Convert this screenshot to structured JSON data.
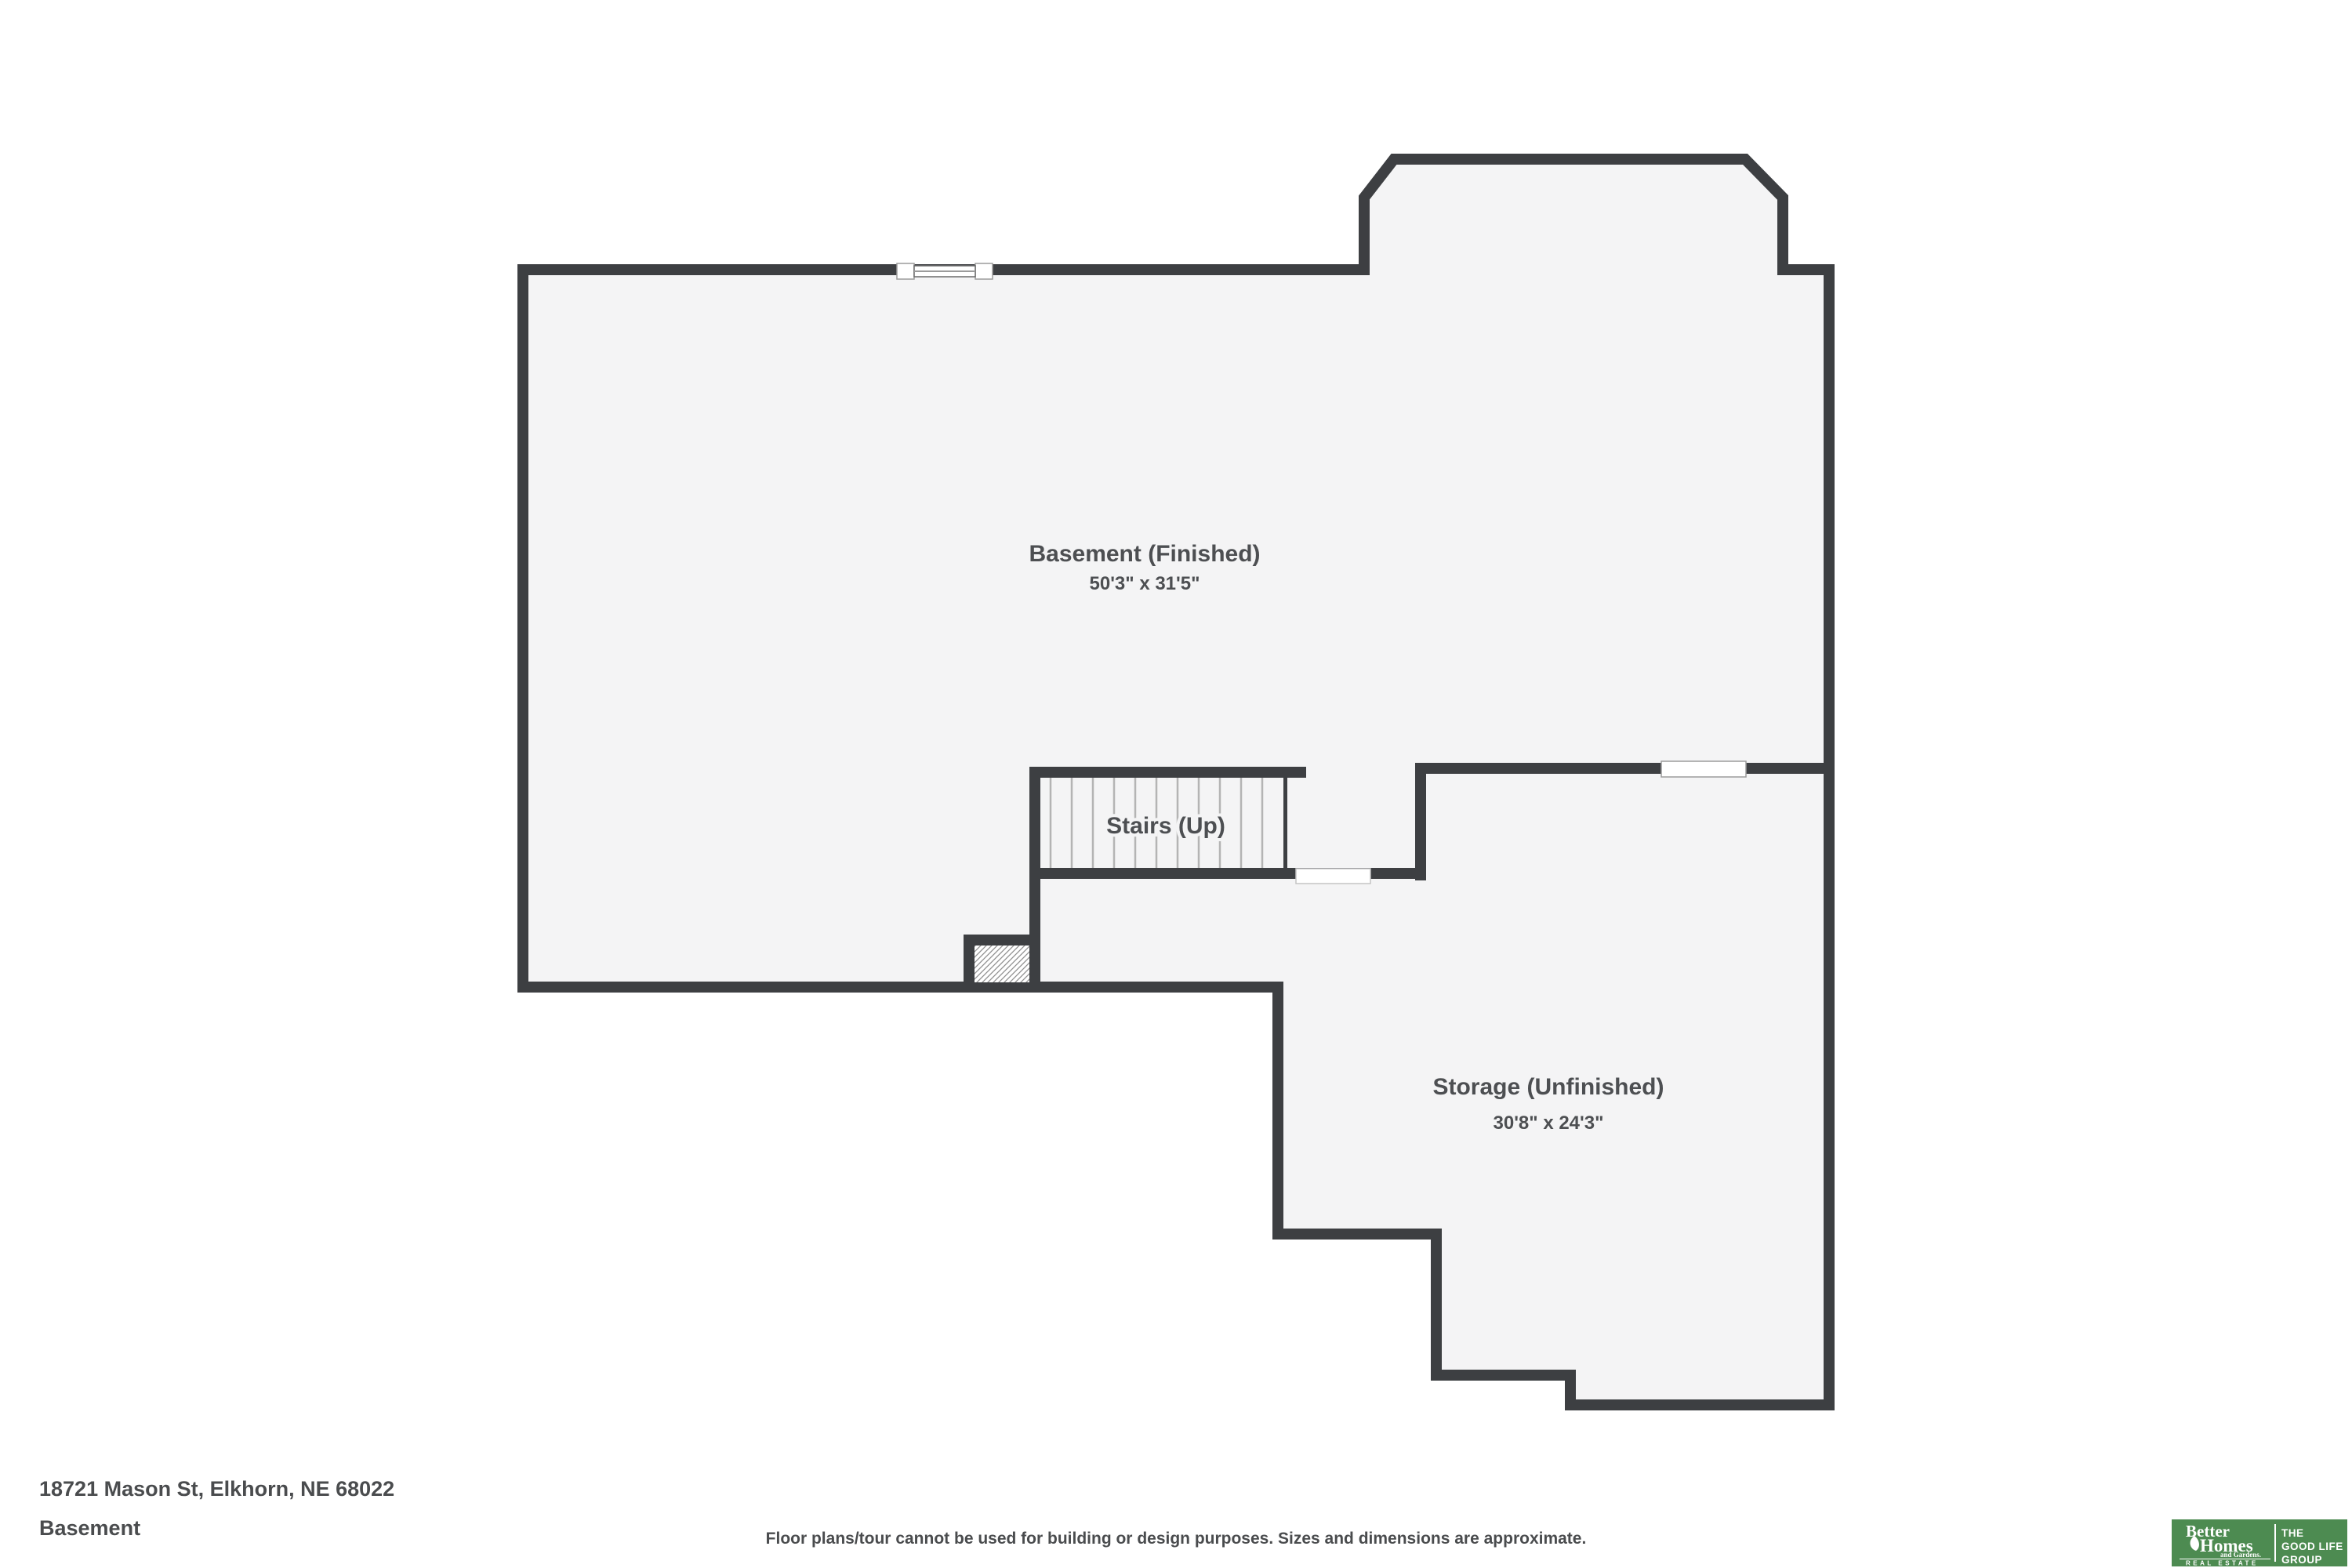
{
  "plan": {
    "rooms": {
      "basement": {
        "label": "Basement (Finished)",
        "dims": "50'3\" x 31'5\""
      },
      "stairs": {
        "label": "Stairs (Up)"
      },
      "storage": {
        "label": "Storage (Unfinished)",
        "dims": "30'8\" x 24'3\""
      }
    }
  },
  "footer": {
    "address": "18721 Mason St, Elkhorn, NE 68022",
    "level": "Basement",
    "disclaimer": "Floor plans/tour cannot be used for building or design purposes. Sizes and dimensions are approximate."
  },
  "logo": {
    "brand_word1": "Better",
    "brand_word2": "Homes",
    "brand_word3": "and Gardens.",
    "brand_word4": "REAL ESTATE",
    "tag_word1": "THE",
    "tag_word2": "GOOD LIFE",
    "tag_word3": "GROUP"
  },
  "colors": {
    "background": "#ffffff",
    "wall": "#3d3f42",
    "floor": "#f4f4f5",
    "label_text": "#4d4f52",
    "footer_text": "#4a4c4e",
    "tread_line": "#b4b4b4",
    "window_frame": "#9b9b9b",
    "hatch_line": "#8f8f8f",
    "logo_green": "#4d8b51"
  }
}
